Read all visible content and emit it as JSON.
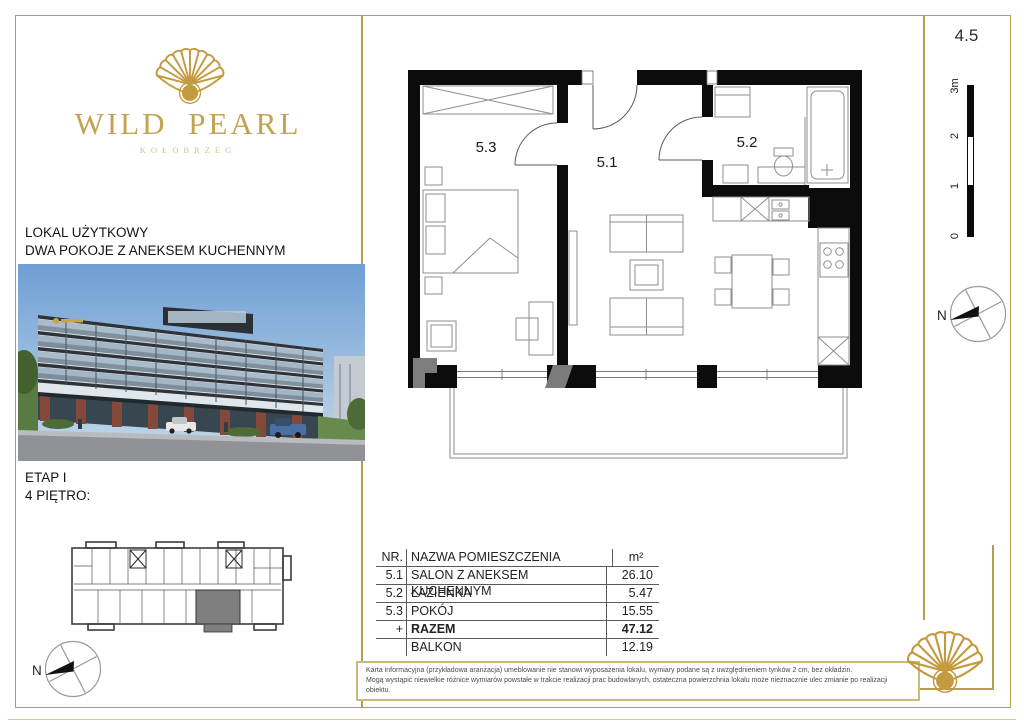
{
  "brand": {
    "name": "WILD PEARL",
    "city": "KOŁOBRZEG"
  },
  "unit": {
    "type_label": "LOKAL UŻYTKOWY",
    "layout_label": "DWA POKOJE Z ANEKSEM KUCHENNYM",
    "stage": "ETAP I",
    "floor": "4 PIĘTRO:",
    "number": "4.5"
  },
  "plan": {
    "room_labels": [
      "5.1",
      "5.2",
      "5.3"
    ],
    "scale_labels": [
      "0",
      "1",
      "2",
      "3m"
    ],
    "compass_label": "N"
  },
  "table": {
    "headers": {
      "nr": "NR.",
      "name": "NAZWA POMIESZCZENIA",
      "area": "m²"
    },
    "rows": [
      {
        "nr": "5.1",
        "name": "SALON Z ANEKSEM KUCHENNYM",
        "area": "26.10"
      },
      {
        "nr": "5.2",
        "name": "ŁAZIENKA",
        "area": "5.47"
      },
      {
        "nr": "5.3",
        "name": "POKÓJ",
        "area": "15.55"
      },
      {
        "nr": "+",
        "name": "RAZEM",
        "area": "47.12"
      },
      {
        "nr": "",
        "name": "BALKON",
        "area": "12.19"
      }
    ]
  },
  "disclaimer": {
    "line1": "Karta informacyjna (przykładowa aranżacja) umeblowanie nie stanowi wyposażenia lokalu, wymiary podane są z uwzględnieniem tynków 2 cm, bez okładzin.",
    "line2": "Mogą wystąpić niewielkie różnice wymiarów powstałe w trakcie realizacji prac budowlanych, ostateczna powierzchnia lokalu może nieznacznie ulec zmianie po realizacji obiektu."
  },
  "colors": {
    "gold": "#b99c52",
    "shell_gold": "#c49a3f",
    "wall": "#0c0c0c",
    "unit_highlight": "#7f7f7f"
  }
}
